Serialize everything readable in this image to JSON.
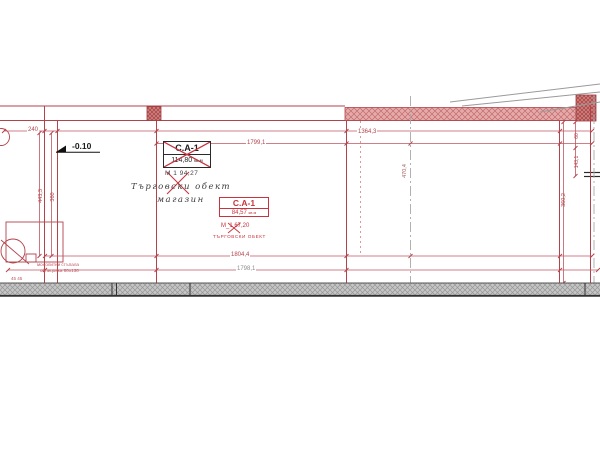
{
  "drawing": {
    "title": "ground-floor-plan-fragment",
    "level_marker": "-0.10",
    "unit_a": {
      "code": "C.A-1",
      "area": "114,80",
      "area_unit": "кв.м",
      "note": "М 1  94,27",
      "hand_line1": "Търговски обект",
      "hand_line2": "магазин"
    },
    "unit_b": {
      "code": "C.A-1",
      "area": "84,57",
      "area_unit": "кв.м",
      "note": "М_1  67,20",
      "name": "ТЪРГОВСКИ ОБЕКТ"
    },
    "stairs_note": {
      "line1": "монолитни стъпала",
      "line2": "облицовка 80х130"
    },
    "dimensions": {
      "top_small": "240",
      "top_right": "1364,3",
      "top_inner": "1799,1",
      "bottom_inner": "1804,4",
      "bottom_outer": "1798,1",
      "left_vert_1": "443,3",
      "left_vert_2": "360",
      "mid_vert": "470,4",
      "right_vert_small": "60",
      "right_vert_1": "143,1",
      "right_vert_2": "360,2",
      "stair_small": "45 45"
    },
    "colors": {
      "line_red": "#b3434b",
      "wall_fill": "#e2a3a3",
      "wall_hatch": "#c46b6b",
      "band_gray": "#c6c6c6",
      "grid_gray": "#a6a6a6"
    }
  }
}
